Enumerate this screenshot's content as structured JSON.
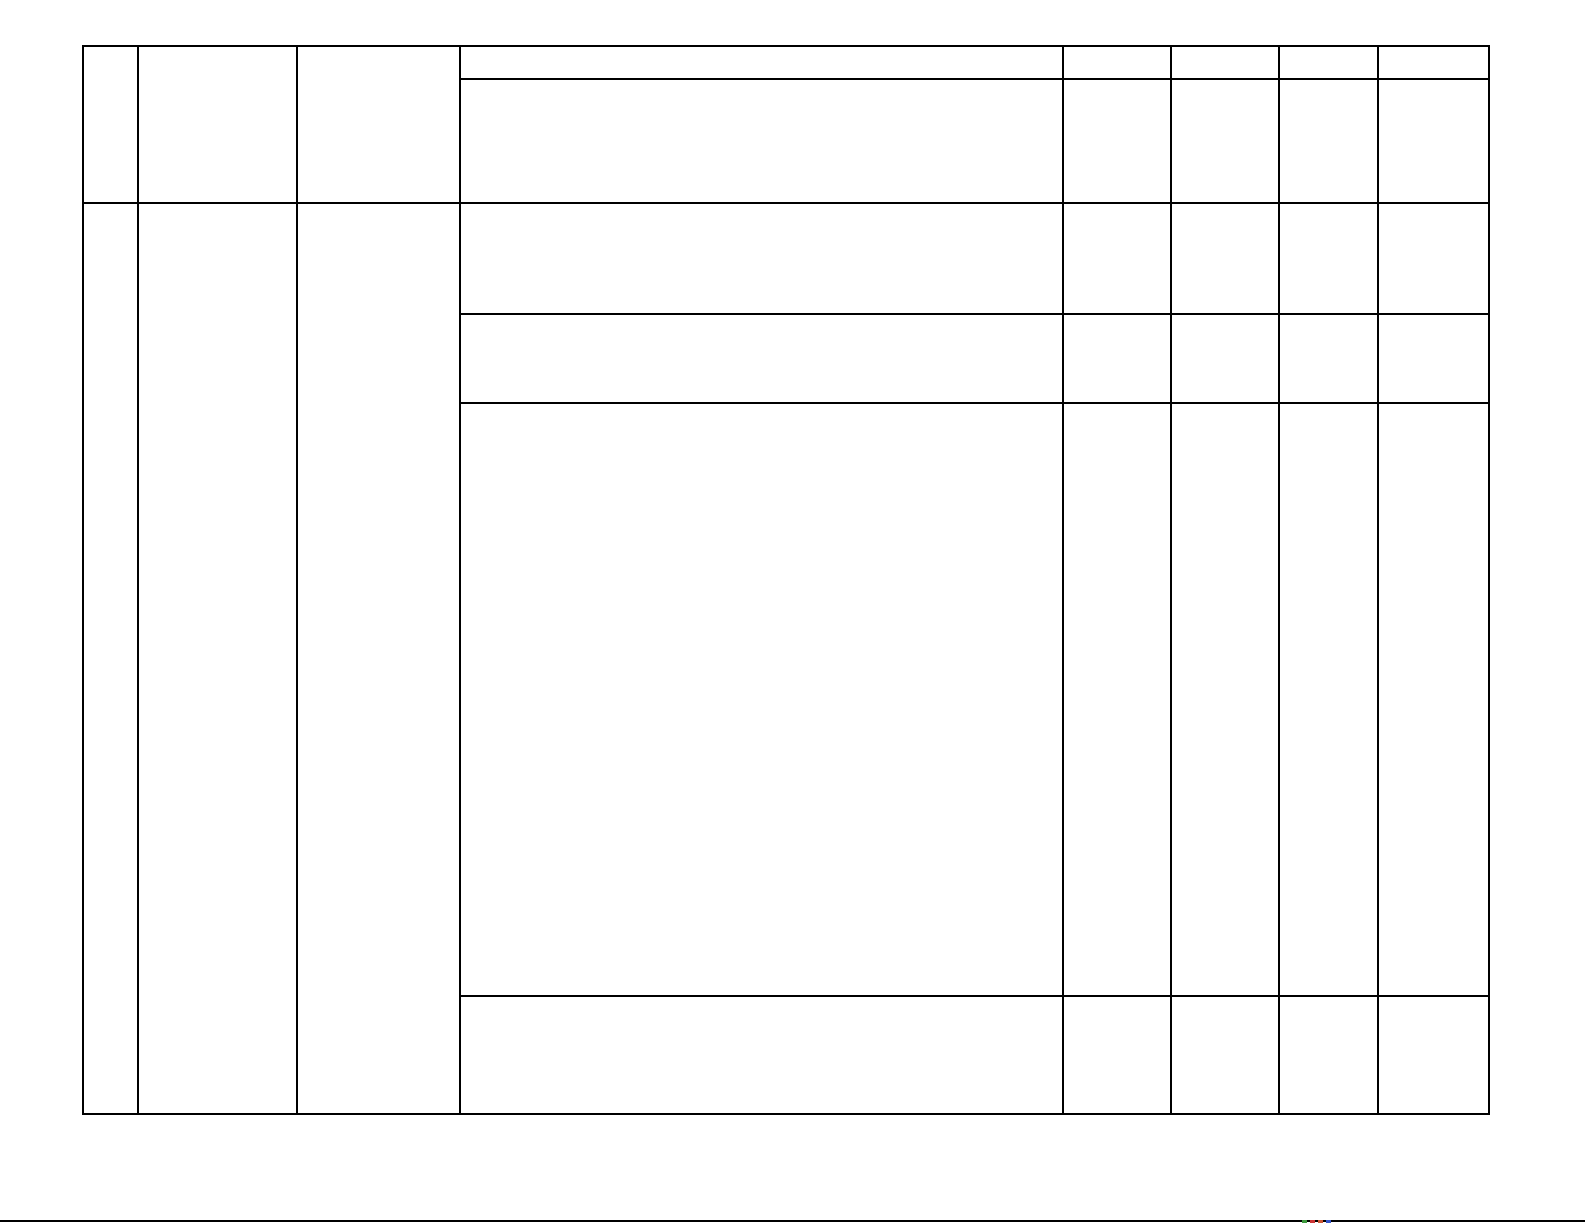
{
  "page": {
    "width": 1585,
    "height": 1225,
    "background_color": "#ffffff"
  },
  "table": {
    "description": "empty-document-table",
    "line_color": "#000000",
    "line_width": 2,
    "bounds": {
      "left": 82,
      "top": 45,
      "right": 1488,
      "bottom": 1113
    },
    "column_edges": [
      82,
      137,
      296,
      459,
      1062,
      1170,
      1278,
      1377,
      1488
    ],
    "row_edges": [
      45,
      78,
      202,
      313,
      402,
      995,
      1113
    ],
    "cells": [
      {
        "id": "c1-r1r2",
        "x": 82,
        "y": 45,
        "w": 55,
        "h": 157,
        "text": ""
      },
      {
        "id": "c2-r1r2",
        "x": 137,
        "y": 45,
        "w": 159,
        "h": 157,
        "text": ""
      },
      {
        "id": "c3-r1r2",
        "x": 296,
        "y": 45,
        "w": 163,
        "h": 157,
        "text": ""
      },
      {
        "id": "c4-r1",
        "x": 459,
        "y": 45,
        "w": 603,
        "h": 33,
        "text": ""
      },
      {
        "id": "c5-r1",
        "x": 1062,
        "y": 45,
        "w": 108,
        "h": 33,
        "text": ""
      },
      {
        "id": "c6-r1",
        "x": 1170,
        "y": 45,
        "w": 108,
        "h": 33,
        "text": ""
      },
      {
        "id": "c7-r1",
        "x": 1278,
        "y": 45,
        "w": 99,
        "h": 33,
        "text": ""
      },
      {
        "id": "c8-r1",
        "x": 1377,
        "y": 45,
        "w": 111,
        "h": 33,
        "text": ""
      },
      {
        "id": "c4-r2",
        "x": 459,
        "y": 78,
        "w": 603,
        "h": 124,
        "text": ""
      },
      {
        "id": "c5-r2",
        "x": 1062,
        "y": 78,
        "w": 108,
        "h": 124,
        "text": ""
      },
      {
        "id": "c6-r2",
        "x": 1170,
        "y": 78,
        "w": 108,
        "h": 124,
        "text": ""
      },
      {
        "id": "c7-r2",
        "x": 1278,
        "y": 78,
        "w": 99,
        "h": 124,
        "text": ""
      },
      {
        "id": "c8-r2",
        "x": 1377,
        "y": 78,
        "w": 111,
        "h": 124,
        "text": ""
      },
      {
        "id": "c1-r3r6",
        "x": 82,
        "y": 202,
        "w": 55,
        "h": 911,
        "text": ""
      },
      {
        "id": "c2-r3r6",
        "x": 137,
        "y": 202,
        "w": 159,
        "h": 911,
        "text": ""
      },
      {
        "id": "c3-r3r6",
        "x": 296,
        "y": 202,
        "w": 163,
        "h": 911,
        "text": ""
      },
      {
        "id": "c4-r3",
        "x": 459,
        "y": 202,
        "w": 603,
        "h": 111,
        "text": ""
      },
      {
        "id": "c5-r3",
        "x": 1062,
        "y": 202,
        "w": 108,
        "h": 111,
        "text": ""
      },
      {
        "id": "c6-r3",
        "x": 1170,
        "y": 202,
        "w": 108,
        "h": 111,
        "text": ""
      },
      {
        "id": "c7-r3",
        "x": 1278,
        "y": 202,
        "w": 99,
        "h": 111,
        "text": ""
      },
      {
        "id": "c8-r3",
        "x": 1377,
        "y": 202,
        "w": 111,
        "h": 111,
        "text": ""
      },
      {
        "id": "c4-r4",
        "x": 459,
        "y": 313,
        "w": 603,
        "h": 89,
        "text": ""
      },
      {
        "id": "c5-r4",
        "x": 1062,
        "y": 313,
        "w": 108,
        "h": 89,
        "text": ""
      },
      {
        "id": "c6-r4",
        "x": 1170,
        "y": 313,
        "w": 108,
        "h": 89,
        "text": ""
      },
      {
        "id": "c7-r4",
        "x": 1278,
        "y": 313,
        "w": 99,
        "h": 89,
        "text": ""
      },
      {
        "id": "c8-r4",
        "x": 1377,
        "y": 313,
        "w": 111,
        "h": 89,
        "text": ""
      },
      {
        "id": "c4-r5",
        "x": 459,
        "y": 402,
        "w": 603,
        "h": 593,
        "text": ""
      },
      {
        "id": "c5-r5",
        "x": 1062,
        "y": 402,
        "w": 108,
        "h": 593,
        "text": ""
      },
      {
        "id": "c6-r5",
        "x": 1170,
        "y": 402,
        "w": 108,
        "h": 593,
        "text": ""
      },
      {
        "id": "c7-r5",
        "x": 1278,
        "y": 402,
        "w": 99,
        "h": 593,
        "text": ""
      },
      {
        "id": "c8-r5",
        "x": 1377,
        "y": 402,
        "w": 111,
        "h": 593,
        "text": ""
      },
      {
        "id": "c4-r6",
        "x": 459,
        "y": 995,
        "w": 603,
        "h": 118,
        "text": ""
      },
      {
        "id": "c5-r6",
        "x": 1062,
        "y": 995,
        "w": 108,
        "h": 118,
        "text": ""
      },
      {
        "id": "c6-r6",
        "x": 1170,
        "y": 995,
        "w": 108,
        "h": 118,
        "text": ""
      },
      {
        "id": "c7-r6",
        "x": 1278,
        "y": 995,
        "w": 99,
        "h": 118,
        "text": ""
      },
      {
        "id": "c8-r6",
        "x": 1377,
        "y": 995,
        "w": 111,
        "h": 118,
        "text": ""
      }
    ]
  },
  "footer_rule": {
    "x": 0,
    "y": 1220,
    "width": 1585,
    "thickness": 2,
    "color": "#000000",
    "marks": [
      {
        "x": 1302,
        "w": 5,
        "h": 3,
        "color": "#3d9a3d"
      },
      {
        "x": 1310,
        "w": 5,
        "h": 3,
        "color": "#cc3333"
      },
      {
        "x": 1318,
        "w": 5,
        "h": 3,
        "color": "#cc5533"
      },
      {
        "x": 1326,
        "w": 5,
        "h": 3,
        "color": "#3355cc"
      }
    ]
  }
}
